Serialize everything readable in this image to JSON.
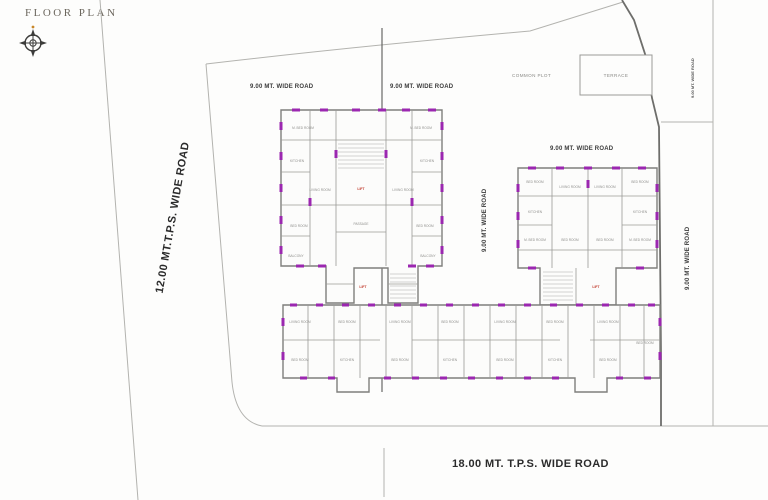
{
  "title": "FLOOR PLAN",
  "roads": {
    "left_vertical": "12.00 MT.T.P.S. WIDE ROAD",
    "bottom": "18.00 MT. T.P.S. WIDE ROAD",
    "top_left": "9.00 MT. WIDE ROAD",
    "top_right": "9.00 MT. WIDE ROAD",
    "right_block_top": "9.00 MT. WIDE ROAD",
    "middle_vertical": "9.00 MT. WIDE ROAD",
    "right_vertical": "9.00 MT. WIDE ROAD",
    "far_right_small": "9.00 MT. WIDE ROAD"
  },
  "site": {
    "common_plot": "COMMON PLOT",
    "terrace": "TERRACE"
  },
  "cores": {
    "left_lift": "LIFT",
    "left_stair": "LIFT",
    "right_stair": "LIFT"
  },
  "rooms": [
    "M. BED ROOM",
    "M. BED ROOM",
    "KITCHEN",
    "KITCHEN",
    "LIVING ROOM",
    "LIVING ROOM",
    "BED ROOM",
    "BED ROOM",
    "BALCONY",
    "BALCONY",
    "PASSAGE",
    "BED ROOM",
    "LIVING ROOM",
    "LIVING ROOM",
    "BED ROOM",
    "KITCHEN",
    "KITCHEN",
    "M. BED ROOM",
    "M. BED ROOM",
    "BED ROOM",
    "BED ROOM",
    "LIVING ROOM",
    "BED ROOM",
    "BED ROOM",
    "KITCHEN",
    "LIVING ROOM",
    "BED ROOM",
    "BED ROOM",
    "KITCHEN",
    "LIVING ROOM",
    "BED ROOM",
    "BED ROOM",
    "KITCHEN",
    "LIVING ROOM",
    "BED ROOM",
    "BED ROOM"
  ],
  "colors": {
    "marker_purple": "#9b27b0",
    "core_red": "#c0392b"
  }
}
